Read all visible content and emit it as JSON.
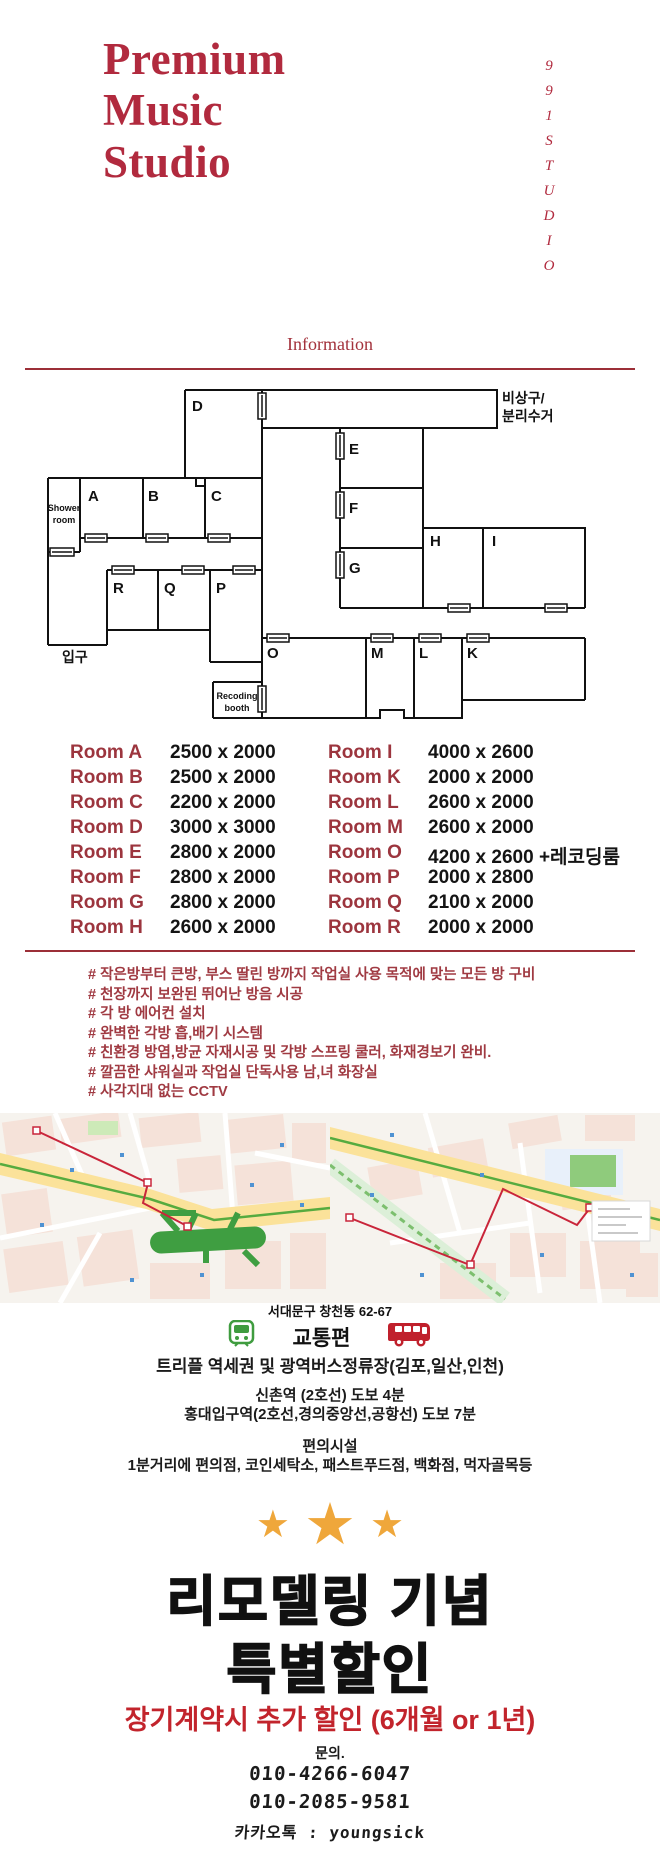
{
  "header": {
    "title_line1": "Premium",
    "title_line2": "Music",
    "title_line3": "Studio",
    "studio_vertical": "991STUDIO"
  },
  "info": {
    "heading": "Information"
  },
  "floorplan": {
    "labels": {
      "A": "A",
      "B": "B",
      "C": "C",
      "D": "D",
      "E": "E",
      "F": "F",
      "G": "G",
      "H": "H",
      "I": "I",
      "K": "K",
      "L": "L",
      "M": "M",
      "O": "O",
      "P": "P",
      "Q": "Q",
      "R": "R"
    },
    "shower_line1": "Shower",
    "shower_line2": "room",
    "booth_line1": "Recoding",
    "booth_line2": "booth",
    "entrance": "입구",
    "emergency_line1": "비상구/",
    "emergency_line2": "분리수거"
  },
  "size_table": {
    "left": [
      {
        "room": "Room A",
        "size": "2500 x 2000"
      },
      {
        "room": "Room B",
        "size": "2500 x 2000"
      },
      {
        "room": "Room C",
        "size": "2200 x 2000"
      },
      {
        "room": "Room D",
        "size": "3000 x 3000"
      },
      {
        "room": "Room E",
        "size": "2800 x 2000"
      },
      {
        "room": "Room F",
        "size": "2800 x 2000"
      },
      {
        "room": "Room G",
        "size": "2800 x 2000"
      },
      {
        "room": "Room H",
        "size": "2600 x 2000"
      }
    ],
    "right": [
      {
        "room": "Room I",
        "size": "4000 x 2600"
      },
      {
        "room": "Room K",
        "size": "2000 x 2000"
      },
      {
        "room": "Room L",
        "size": "2600 x 2000"
      },
      {
        "room": "Room M",
        "size": "2600 x 2000"
      },
      {
        "room": "Room O",
        "size": "4200 x 2600 +레코딩룸"
      },
      {
        "room": "Room P",
        "size": "2000 x 2800"
      },
      {
        "room": "Room Q",
        "size": "2100 x 2000"
      },
      {
        "room": "Room R",
        "size": "2000 x 2000"
      }
    ]
  },
  "features": {
    "items": [
      "# 작은방부터 큰방, 부스 딸린 방까지 작업실 사용 목적에 맞는 모든 방 구비",
      "# 천장까지 보완된 뛰어난 방음 시공",
      "# 각 방 에어컨 설치",
      "# 완벽한 각방 흡,배기 시스템",
      "# 친환경 방염,방균 자재시공 및 각방 스프링 쿨러, 화재경보기 완비.",
      "# 깔끔한 샤워실과 작업실 단독사용 남,녀 화장실",
      "# 사각지대 없는 CCTV"
    ]
  },
  "location": {
    "address": "서대문구 창천동 62-67"
  },
  "transport": {
    "heading": "교통편",
    "line1": "트리플 역세권 및 광역버스정류장(김포,일산,인천)",
    "line2": "신촌역 (2호선) 도보 4분",
    "line3": "홍대입구역(2호선,경의중앙선,공항선) 도보 7분",
    "facilities_heading": "편의시설",
    "facilities": "1분거리에 편의점, 코인세탁소, 패스트푸드점, 백화점, 먹자골목등"
  },
  "promo": {
    "star": "★",
    "line1": "리모델링 기념",
    "line2": "특별할인",
    "discount": "장기계약시 추가 할인 (6개월 or 1년)"
  },
  "contact": {
    "label": "문의.",
    "phone1": "010-4266-6047",
    "phone2": "010-2085-9581",
    "kakao": "카카오톡 : youngsick"
  },
  "colors": {
    "title_red": "#b12a3e",
    "table_label_red": "#9c353e",
    "feature_red": "#a03a42",
    "promo_red": "#c2242c",
    "star_gold": "#efa73b",
    "train_green": "#3f9c3f",
    "bus_red": "#c0202c"
  }
}
